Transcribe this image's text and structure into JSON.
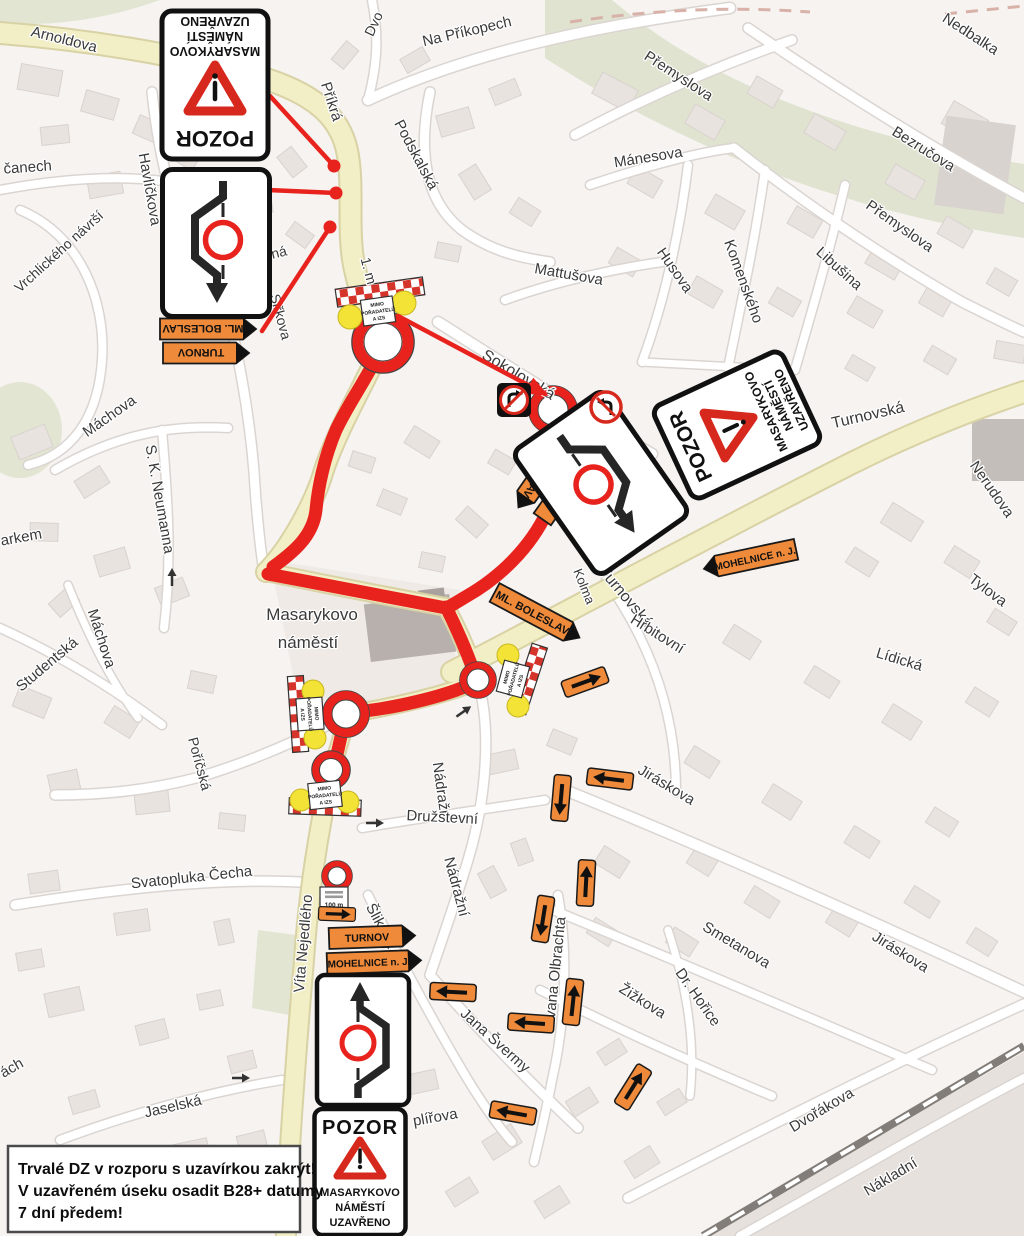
{
  "colors": {
    "route_red": "#e8231d",
    "detour_orange": "#ee8a3a",
    "road_yellow": "#f2eec6",
    "barrier_red": "#d5342a",
    "beacon_yellow": "#f2e336",
    "map_bg": "#f6f3f1",
    "green_area": "#e2e5d2",
    "building": "#e9e3e0"
  },
  "note": {
    "l1": "Trvalé DZ v rozporu s uzavírkou zakrýt!",
    "l2": "V uzavřeném úseku osadit B28+ datumy",
    "l3": "7 dní předem!"
  },
  "signs": {
    "pozor": {
      "title": "POZOR",
      "l1": "MASARYKOVO",
      "l2": "NÁMĚSTÍ",
      "l3": "UZAVŘENO"
    },
    "turnov": "TURNOV",
    "ml_boleslav": "ML. BOLESLAV",
    "mohelnice": "MOHELNICE n. J.",
    "closure_plate": {
      "l1": "MIMO",
      "l2": "POŘADATELŮ",
      "l3": "A IZS"
    },
    "distance_plate": "100 m"
  },
  "street_labels": [
    {
      "t": "Arnoldova",
      "x": 63,
      "y": 44,
      "r": 14,
      "s": 15
    },
    {
      "t": "Dvo",
      "x": 378,
      "y": 26,
      "r": -65,
      "s": 14
    },
    {
      "t": "Na Příkopech",
      "x": 468,
      "y": 36,
      "r": -13,
      "s": 15
    },
    {
      "t": "Nedbalka",
      "x": 968,
      "y": 38,
      "r": 33,
      "s": 15
    },
    {
      "t": "Přemyslova",
      "x": 676,
      "y": 80,
      "r": 33,
      "s": 15
    },
    {
      "t": "Mánesova",
      "x": 649,
      "y": 162,
      "r": -9,
      "s": 15
    },
    {
      "t": "Bezručova",
      "x": 921,
      "y": 153,
      "r": 32,
      "s": 15
    },
    {
      "t": "Přemyslova",
      "x": 897,
      "y": 230,
      "r": 35,
      "s": 15
    },
    {
      "t": "Husova",
      "x": 671,
      "y": 273,
      "r": 55,
      "s": 15
    },
    {
      "t": "Komenského",
      "x": 739,
      "y": 283,
      "r": 70,
      "s": 15
    },
    {
      "t": "Libušina",
      "x": 836,
      "y": 272,
      "r": 42,
      "s": 15
    },
    {
      "t": "Mattušova",
      "x": 568,
      "y": 279,
      "r": 10,
      "s": 15
    },
    {
      "t": "Příkrá",
      "x": 327,
      "y": 103,
      "r": 72,
      "s": 15
    },
    {
      "t": "Podskalská",
      "x": 412,
      "y": 157,
      "r": 62,
      "s": 15
    },
    {
      "t": "čanech",
      "x": 28,
      "y": 172,
      "r": -4,
      "s": 15
    },
    {
      "t": "Havlíčkova",
      "x": 145,
      "y": 190,
      "r": 80,
      "s": 15
    },
    {
      "t": "Vrchlického návrší",
      "x": 62,
      "y": 255,
      "r": -42,
      "s": 14
    },
    {
      "t": "Máchova",
      "x": 112,
      "y": 420,
      "r": -35,
      "s": 15
    },
    {
      "t": "S. K. Neumanna",
      "x": 155,
      "y": 500,
      "r": 80,
      "s": 15
    },
    {
      "t": "arkem",
      "x": 22,
      "y": 542,
      "r": -10,
      "s": 15
    },
    {
      "t": "Studentská",
      "x": 50,
      "y": 668,
      "r": -40,
      "s": 15
    },
    {
      "t": "Máchova",
      "x": 97,
      "y": 640,
      "r": 72,
      "s": 15
    },
    {
      "t": "Příčná",
      "x": 268,
      "y": 260,
      "r": -14,
      "s": 14
    },
    {
      "t": "Siřkova",
      "x": 276,
      "y": 318,
      "r": 75,
      "s": 14
    },
    {
      "t": "1. m",
      "x": 364,
      "y": 272,
      "r": 75,
      "s": 14
    },
    {
      "t": "Sokolovská",
      "x": 516,
      "y": 379,
      "r": 31,
      "s": 16
    },
    {
      "t": "Kolma",
      "x": 580,
      "y": 588,
      "r": 68,
      "s": 13
    },
    {
      "t": "Turnovská",
      "x": 622,
      "y": 600,
      "r": 50,
      "s": 16
    },
    {
      "t": "Turnovská",
      "x": 869,
      "y": 420,
      "r": -13,
      "s": 16
    },
    {
      "t": "Nerudova",
      "x": 988,
      "y": 492,
      "r": 55,
      "s": 15
    },
    {
      "t": "Tylova",
      "x": 985,
      "y": 594,
      "r": 37,
      "s": 15
    },
    {
      "t": "Lídická",
      "x": 898,
      "y": 664,
      "r": 17,
      "s": 15
    },
    {
      "t": "Hřbitovní",
      "x": 655,
      "y": 638,
      "r": 32,
      "s": 15
    },
    {
      "t": "Masarykovo",
      "x": 312,
      "y": 620,
      "r": 0,
      "s": 17
    },
    {
      "t": "náměstí",
      "x": 308,
      "y": 648,
      "r": 0,
      "s": 17
    },
    {
      "t": "Poříčská",
      "x": 195,
      "y": 765,
      "r": 75,
      "s": 14
    },
    {
      "t": "Nádražní",
      "x": 437,
      "y": 793,
      "r": 82,
      "s": 15
    },
    {
      "t": "Nádražní",
      "x": 452,
      "y": 888,
      "r": 75,
      "s": 15
    },
    {
      "t": "Družstevní",
      "x": 442,
      "y": 822,
      "r": 3,
      "s": 15
    },
    {
      "t": "Svatopluka Čecha",
      "x": 192,
      "y": 882,
      "r": -6,
      "s": 15
    },
    {
      "t": "Víta Nejedlého",
      "x": 308,
      "y": 944,
      "r": -85,
      "s": 15
    },
    {
      "t": "Šlikova",
      "x": 377,
      "y": 928,
      "r": 62,
      "s": 15
    },
    {
      "t": "Jaselská",
      "x": 174,
      "y": 1111,
      "r": -13,
      "s": 15
    },
    {
      "t": "ách",
      "x": 14,
      "y": 1072,
      "r": -30,
      "s": 15
    },
    {
      "t": "Jana Švermy",
      "x": 492,
      "y": 1044,
      "r": 42,
      "s": 15
    },
    {
      "t": "Ivana Olbrachta",
      "x": 560,
      "y": 970,
      "r": -84,
      "s": 15
    },
    {
      "t": "Žižkova",
      "x": 640,
      "y": 1005,
      "r": 32,
      "s": 15
    },
    {
      "t": "Dr. Hořice",
      "x": 694,
      "y": 1000,
      "r": 55,
      "s": 15
    },
    {
      "t": "Smetanova",
      "x": 734,
      "y": 949,
      "r": 31,
      "s": 15
    },
    {
      "t": "Jiráskova",
      "x": 664,
      "y": 789,
      "r": 31,
      "s": 15
    },
    {
      "t": "Jiráskova",
      "x": 898,
      "y": 956,
      "r": 32,
      "s": 15
    },
    {
      "t": "Dvořákova",
      "x": 824,
      "y": 1114,
      "r": -31,
      "s": 15
    },
    {
      "t": "Nákladní",
      "x": 893,
      "y": 1181,
      "r": -31,
      "s": 15
    },
    {
      "t": "plířova",
      "x": 436,
      "y": 1122,
      "r": -10,
      "s": 15
    }
  ],
  "detour_arrows": [
    {
      "x": 585,
      "y": 682,
      "r": -20,
      "sc": 1
    },
    {
      "x": 610,
      "y": 779,
      "r": 187,
      "sc": 1
    },
    {
      "x": 561,
      "y": 798,
      "r": 95,
      "sc": 1
    },
    {
      "x": 586,
      "y": 883,
      "r": -87,
      "sc": 1
    },
    {
      "x": 543,
      "y": 919,
      "r": 99,
      "sc": 1
    },
    {
      "x": 573,
      "y": 1002,
      "r": -84,
      "sc": 1
    },
    {
      "x": 531,
      "y": 1023,
      "r": 184,
      "sc": 1
    },
    {
      "x": 453,
      "y": 992,
      "r": 183,
      "sc": 1
    },
    {
      "x": 633,
      "y": 1087,
      "r": -58,
      "sc": 1
    },
    {
      "x": 513,
      "y": 1113,
      "r": 190,
      "sc": 1
    },
    {
      "x": 337,
      "y": 914,
      "r": 2,
      "sc": 0.8
    }
  ],
  "direction_signs": [
    {
      "label": "ML. BOLESLAV",
      "x": 208,
      "y": 329,
      "r": 180,
      "w": 96,
      "tip": "left",
      "fs": 11
    },
    {
      "label": "TURNOV",
      "x": 206,
      "y": 353,
      "r": 180,
      "w": 86,
      "tip": "left",
      "fs": 11
    },
    {
      "label": "TURNOV",
      "x": 567,
      "y": 484,
      "r": -55,
      "w": 86,
      "tip": "right",
      "fs": 11
    },
    {
      "label": "ML. BOLESLAV",
      "x": 546,
      "y": 468,
      "r": 125,
      "w": 96,
      "tip": "right",
      "fs": 11
    },
    {
      "label": "ML. BOLESLAV",
      "x": 537,
      "y": 615,
      "r": 28,
      "w": 96,
      "tip": "right",
      "fs": 11
    },
    {
      "label": "MOHELNICE n. J.",
      "x": 750,
      "y": 559,
      "r": -12,
      "w": 94,
      "tip": "left",
      "fs": 10
    },
    {
      "label": "TURNOV",
      "x": 372,
      "y": 937,
      "r": -2,
      "w": 86,
      "tip": "right",
      "fs": 10.5
    },
    {
      "label": "MOHELNICE n. J.",
      "x": 374,
      "y": 962,
      "r": -2,
      "w": 94,
      "tip": "right",
      "fs": 10
    }
  ]
}
